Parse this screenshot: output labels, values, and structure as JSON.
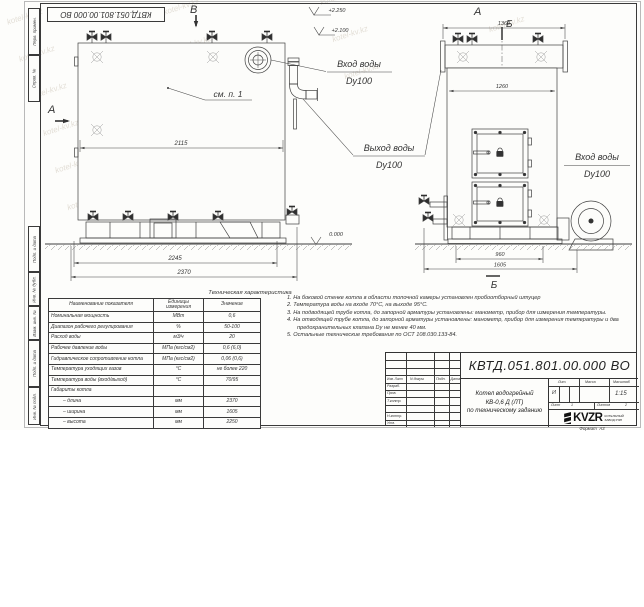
{
  "watermark": {
    "text": "kotel-kv.kz"
  },
  "stamp_top": "КВТД.051.801.00.000 ВО",
  "side_strip": {
    "labels": [
      "Перв. примен.",
      "Справ. №",
      "Подп. и дата",
      "Инв. № дубл.",
      "Взам. инв. №",
      "Подп. и дата",
      "Инв. № подл."
    ]
  },
  "front_view": {
    "section_b_label": "В",
    "section_a_label": "А",
    "see_note": "см. п. 1",
    "dim_width_body": "2115",
    "dim_width_frame": "2245",
    "dim_width_total": "2370",
    "elev_top": "+2.250",
    "elev_mid": "+2.100",
    "elev_zero": "0.000",
    "inlet_title": "Вход воды",
    "inlet_dn": "Dy100",
    "outlet_title": "Выход воды",
    "outlet_dn": "Dy100"
  },
  "side_view": {
    "view_label": "А",
    "section_b_top": "Б",
    "section_b_bottom": "Б",
    "dim_width_top": "1360",
    "dim_width_body": "1260",
    "dim_base": "960",
    "dim_total": "1605",
    "inlet_title": "Вход воды",
    "inlet_dn": "Dy100"
  },
  "spec_table": {
    "title": "Техническая характеристика",
    "col_name": "Наименование показателя",
    "col_units": "Единицы измерения",
    "col_value": "Значение",
    "rows": [
      [
        "Номинальная мощность",
        "МВт",
        "0,6"
      ],
      [
        "Диапазон рабочего регулирования",
        "%",
        "50-100"
      ],
      [
        "Расход воды",
        "м3/ч",
        "20"
      ],
      [
        "Рабочее давление воды",
        "МПа (кгс/см2)",
        "0,6 (6,0)"
      ],
      [
        "Гидравлическое сопротивление котла",
        "МПа (кгс/см2)",
        "0,06 (0,6)"
      ],
      [
        "Температура уходящих газов",
        "°С",
        "не более 220"
      ],
      [
        "Температура воды (вход/выход)",
        "°С",
        "70/95"
      ],
      [
        "Габариты котла",
        "",
        ""
      ],
      [
        "– длина",
        "мм",
        "2370"
      ],
      [
        "– ширина",
        "мм",
        "1605"
      ],
      [
        "– высота",
        "мм",
        "2250"
      ]
    ]
  },
  "notes": [
    "1. На боковой стенке котла в области топочной камеры установлен пробоотборный штуцер",
    "2. Температура воды на входе 70°С, на выходе 95°С.",
    "3. На подводящей трубе котла, до запорной арматуры установлены: манометр, прибор для измерения температуры.",
    "4. На отводящей трубе котла, до запорной арматуры установлены: манометр, прибор для измерения температуры и два предохранительных клапана Dy не менее 40 мм.",
    "5. Остальные технические требования по ОСТ 108.030.133-84."
  ],
  "title_block": {
    "doc_number": "КВТД.051.801.00.000 ВО",
    "product_line1": "Котел водогрейный",
    "product_line2": "КВ-0,6 Д (ЛТ)",
    "product_line3": "по техническому заданию",
    "col_izm": "Изм. Лист",
    "col_docnum": "N докум.",
    "col_podp": "Подп.",
    "col_data": "Дата",
    "row_razrab": "Разраб.",
    "row_prov": "Пров.",
    "row_tkontr": "Т.контр.",
    "row_nkontr": "Н.контр.",
    "row_utv": "Утв.",
    "lit_label": "Лит.",
    "mass_label": "Масса",
    "scale_label": "Масштаб",
    "lit_value": "И",
    "scale_value": "1:15",
    "sheet_label": "Лист",
    "sheet_value": "1",
    "sheets_label": "Листов",
    "sheets_value": "2",
    "logo_text": "KVZR",
    "company_line1": "КОТЕЛЬНЫЙ",
    "company_line2": "ЗАВОД РЭП",
    "format_label": "Формат",
    "format_value": "А3"
  }
}
